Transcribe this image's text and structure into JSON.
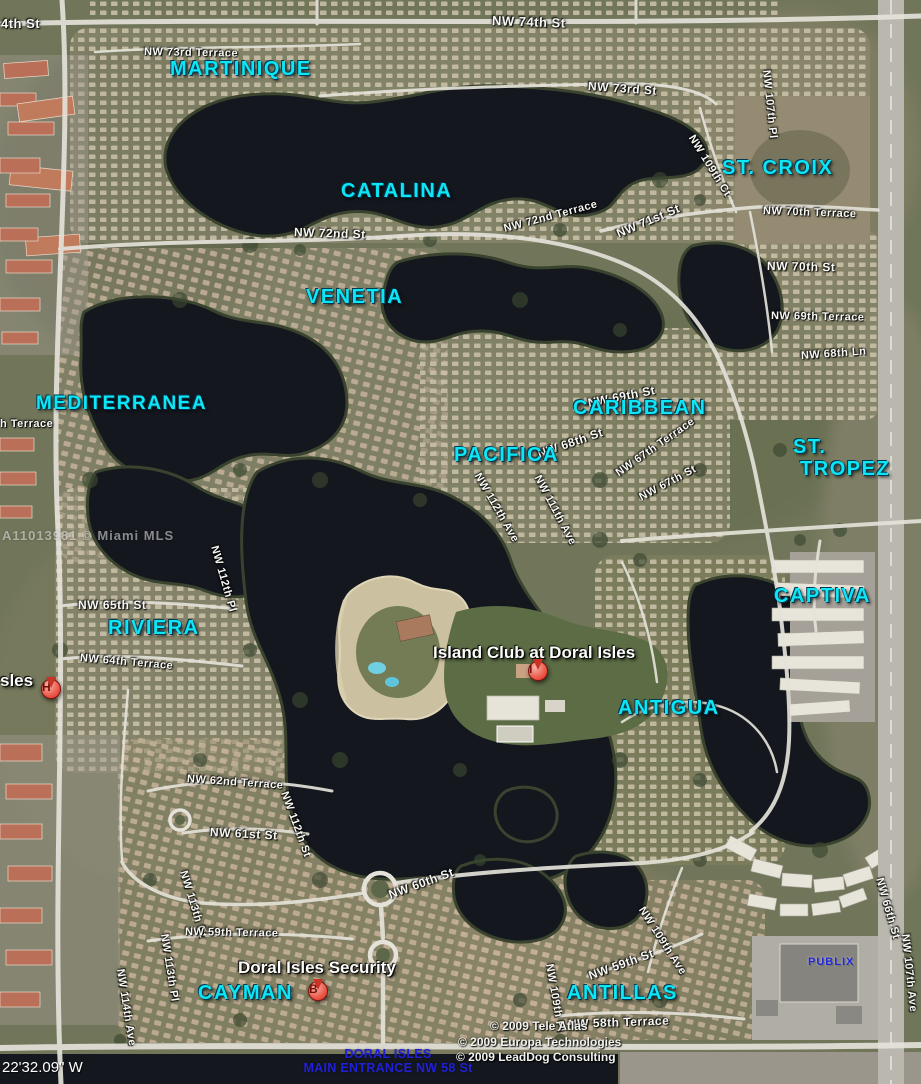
{
  "map": {
    "title": "Doral Isles community aerial map",
    "watermark": "A11013981 © Miami MLS",
    "coordinates_label": "22'32.09\" W",
    "colors": {
      "neighborhood_cyan": "#0ce6f5",
      "street_text": "#f8f8f4",
      "marker_red": "#e84b3c",
      "entrance_blue": "#2020d8",
      "publix_blue": "#2126d6",
      "water": "#14171e",
      "land": "#71765a",
      "road": "#e4e2d9"
    },
    "neighborhoods": [
      {
        "name": "martinique",
        "text": "MARTINIQUE",
        "x": 170,
        "y": 58
      },
      {
        "name": "st-croix",
        "text": "ST. CROIX",
        "x": 722,
        "y": 157
      },
      {
        "name": "catalina",
        "text": "CATALINA",
        "x": 341,
        "y": 180
      },
      {
        "name": "venetia",
        "text": "VENETIA",
        "x": 306,
        "y": 286
      },
      {
        "name": "mediterranea",
        "text": "MEDITERRANEA",
        "x": 36,
        "y": 394,
        "fs": 19
      },
      {
        "name": "caribbean",
        "text": "CARIBBEAN",
        "x": 573,
        "y": 397
      },
      {
        "name": "pacifica",
        "text": "PACIFICA",
        "x": 454,
        "y": 444
      },
      {
        "name": "st-tropez",
        "text": "ST.\n TROPEZ",
        "x": 793,
        "y": 436
      },
      {
        "name": "riviera",
        "text": "RIVIERA",
        "x": 108,
        "y": 617
      },
      {
        "name": "captiva",
        "text": "CAPTIVA",
        "x": 774,
        "y": 585
      },
      {
        "name": "antigua",
        "text": "ANTIGUA",
        "x": 618,
        "y": 697
      },
      {
        "name": "cayman",
        "text": "CAYMAN",
        "x": 198,
        "y": 982
      },
      {
        "name": "antillas",
        "text": "ANTILLAS",
        "x": 567,
        "y": 982
      }
    ],
    "streets": [
      {
        "name": "nw-74th-st-partial",
        "text": "4th St",
        "x": 1,
        "y": 16,
        "rot": 0,
        "fs": 13
      },
      {
        "name": "nw-74th-st",
        "text": "NW 74th St",
        "x": 492,
        "y": 13,
        "rot": 2,
        "fs": 13
      },
      {
        "name": "nw-73rd-terrace",
        "text": "NW 73rd Terrace",
        "x": 144,
        "y": 46,
        "rot": 1
      },
      {
        "name": "nw-73rd-st",
        "text": "NW 73rd St",
        "x": 588,
        "y": 79,
        "rot": 4,
        "fs": 12
      },
      {
        "name": "nw-107th-pl",
        "text": "NW 107th Pl",
        "x": 766,
        "y": 64,
        "rot": 84
      },
      {
        "name": "nw-109th-ct",
        "text": "NW 109th Ct",
        "x": 691,
        "y": 130,
        "rot": 58
      },
      {
        "name": "nw-70th-terrace",
        "text": "NW 70th Terrace",
        "x": 763,
        "y": 205,
        "rot": 2
      },
      {
        "name": "nw-72nd-terrace",
        "text": "NW 72nd Terrace",
        "x": 504,
        "y": 223,
        "rot": -15
      },
      {
        "name": "nw-71st-st",
        "text": "NW 71st St",
        "x": 617,
        "y": 227,
        "rot": -23,
        "fs": 12
      },
      {
        "name": "nw-72nd-st",
        "text": "NW 72nd St",
        "x": 294,
        "y": 225,
        "rot": 2,
        "fs": 12
      },
      {
        "name": "nw-70th-st",
        "text": "NW 70th St",
        "x": 767,
        "y": 259,
        "rot": 1,
        "fs": 12
      },
      {
        "name": "nw-69th-terrace",
        "text": "NW 69th Terrace",
        "x": 771,
        "y": 310,
        "rot": 1
      },
      {
        "name": "nw-68th-ln",
        "text": "NW 68th Ln",
        "x": 801,
        "y": 350,
        "rot": -4
      },
      {
        "name": "nw-69th-st",
        "text": "NW 69th St",
        "x": 588,
        "y": 396,
        "rot": -11,
        "fs": 12
      },
      {
        "name": "nw-68th-st",
        "text": "NW 68th St",
        "x": 538,
        "y": 447,
        "rot": -19,
        "fs": 12
      },
      {
        "name": "nw-67th-terrace",
        "text": "NW 67th Terrace",
        "x": 617,
        "y": 468,
        "rot": -35
      },
      {
        "name": "nw-67th-st",
        "text": "NW 67th St",
        "x": 640,
        "y": 492,
        "rot": -28
      },
      {
        "name": "nw-112th-ave",
        "text": "NW 112th Ave",
        "x": 477,
        "y": 468,
        "rot": 60
      },
      {
        "name": "nw-111th-ave",
        "text": "NW 111th Ave",
        "x": 537,
        "y": 470,
        "rot": 62
      },
      {
        "name": "terrace-partial",
        "text": "h Terrace",
        "x": 0,
        "y": 418,
        "rot": 0
      },
      {
        "name": "nw-65th-st",
        "text": "NW 65th St",
        "x": 78,
        "y": 598,
        "rot": 0,
        "fs": 12
      },
      {
        "name": "nw-112th-pl",
        "text": "NW 112th Pl",
        "x": 214,
        "y": 540,
        "rot": 74
      },
      {
        "name": "nw-64th-terrace",
        "text": "NW 64th Terrace",
        "x": 80,
        "y": 652,
        "rot": 5
      },
      {
        "name": "nw-62nd-terrace",
        "text": "NW 62nd Terrace",
        "x": 187,
        "y": 773,
        "rot": 4
      },
      {
        "name": "nw-112th-st",
        "text": "NW 112th St",
        "x": 284,
        "y": 786,
        "rot": 70
      },
      {
        "name": "nw-61st-st",
        "text": "NW 61st St",
        "x": 210,
        "y": 825,
        "rot": 3,
        "fs": 12
      },
      {
        "name": "nw-113th-ct",
        "text": "NW 113th Ct",
        "x": 183,
        "y": 865,
        "rot": 73
      },
      {
        "name": "nw-60th-st",
        "text": "NW 60th St",
        "x": 389,
        "y": 888,
        "rot": -20,
        "fs": 12
      },
      {
        "name": "nw-66th-st",
        "text": "NW 66th St",
        "x": 879,
        "y": 872,
        "rot": 74
      },
      {
        "name": "nw-107th-ave",
        "text": "NW 107th Ave",
        "x": 905,
        "y": 928,
        "rot": 84
      },
      {
        "name": "nw-59th-terrace",
        "text": "NW 59th Terrace",
        "x": 185,
        "y": 926,
        "rot": 1
      },
      {
        "name": "nw-113th-pl",
        "text": "NW 113th Pl",
        "x": 164,
        "y": 928,
        "rot": 81
      },
      {
        "name": "nw-114th-ave",
        "text": "NW 114th Ave",
        "x": 120,
        "y": 963,
        "rot": 81
      },
      {
        "name": "nw-109th-ave",
        "text": "NW 109th Ave",
        "x": 641,
        "y": 902,
        "rot": 57
      },
      {
        "name": "nw-59th-st",
        "text": "NW 59th St",
        "x": 589,
        "y": 969,
        "rot": -20,
        "fs": 12
      },
      {
        "name": "nw-109th-pl",
        "text": "NW 109th Pl",
        "x": 549,
        "y": 958,
        "rot": 80
      },
      {
        "name": "nw-58th-terrace",
        "text": "NW 58th Terrace",
        "x": 568,
        "y": 1017,
        "rot": -2,
        "fs": 12
      }
    ],
    "places": [
      {
        "name": "island-club",
        "text": "Island Club at Doral Isles",
        "x": 433,
        "y": 643,
        "style": ""
      },
      {
        "name": "doral-isles-security",
        "text": "Doral Isles Security",
        "x": 238,
        "y": 958,
        "style": ""
      },
      {
        "name": "doral-isles-partial",
        "text": "sles",
        "x": 0,
        "y": 671,
        "style": ""
      },
      {
        "name": "publix",
        "text": "PUBLIX",
        "x": 808,
        "y": 956,
        "style": "place-blue"
      }
    ],
    "markers": [
      {
        "letter": "H",
        "x": 51,
        "y": 712
      },
      {
        "letter": "I",
        "x": 538,
        "y": 694
      },
      {
        "letter": "B",
        "x": 318,
        "y": 1014
      }
    ],
    "copyright_lines": [
      {
        "text": "© 2009 Tele Atlas",
        "x": 490,
        "y": 1019
      },
      {
        "text": "© 2009 Europa Technologies",
        "x": 458,
        "y": 1035
      },
      {
        "text": "© 2009 LeadDog Consulting",
        "x": 456,
        "y": 1050
      }
    ],
    "entrance": {
      "line1": "DORAL ISLES",
      "line2": "MAIN ENTRANCE NW 58 St",
      "x": 388,
      "y": 1047
    }
  }
}
